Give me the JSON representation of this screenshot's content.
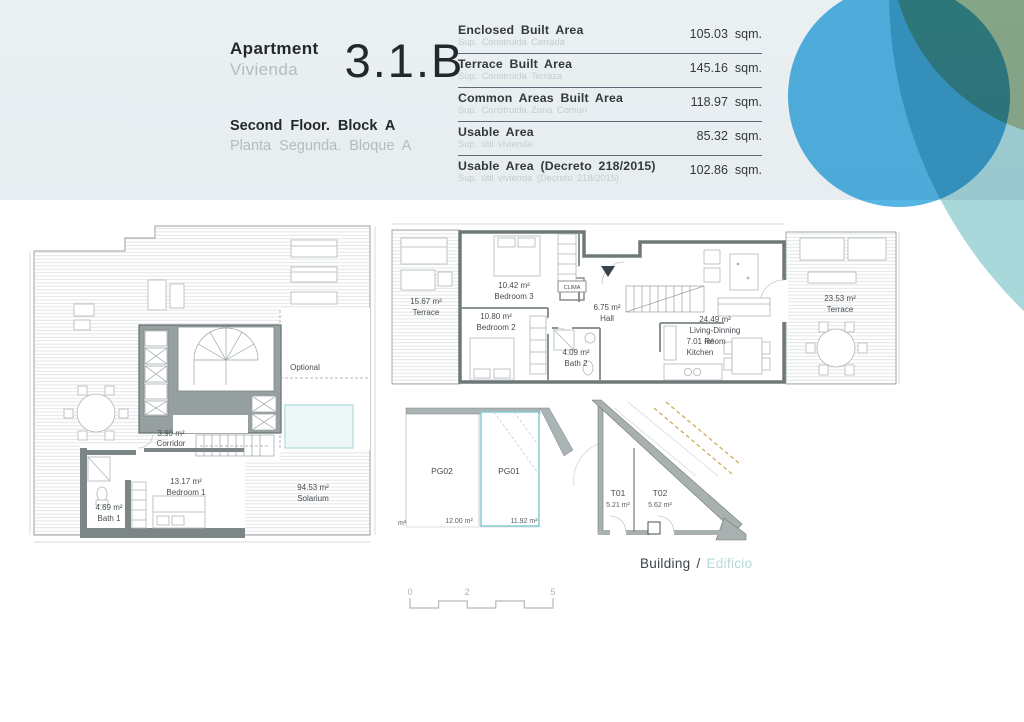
{
  "header": {
    "apartment_en": "Apartment",
    "apartment_es": "Vivienda",
    "unit": "3.1.B",
    "floor_en": "Second Floor. Block A",
    "floor_es": "Planta Segunda. Bloque A"
  },
  "areas_table": {
    "rows": [
      {
        "label_en": "Enclosed Built Area",
        "label_es": "Sup. Construida Cerrada",
        "value": "105.03",
        "unit": "sqm."
      },
      {
        "label_en": "Terrace Built Area",
        "label_es": "Sup. Construida Terraza",
        "value": "145.16",
        "unit": "sqm."
      },
      {
        "label_en": "Common Areas Built Area",
        "label_es": "Sup. Construida Zona Común",
        "value": "118.97",
        "unit": "sqm."
      },
      {
        "label_en": "Usable Area",
        "label_es": "Sup. útil vivienda",
        "value": "85.32",
        "unit": "sqm."
      },
      {
        "label_en": "Usable Area (Decreto 218/2015)",
        "label_es": "Sup. útil vivienda (Decreto 218/2015)",
        "value": "102.86",
        "unit": "sqm."
      }
    ]
  },
  "solarium_plan": {
    "rooms": [
      {
        "area": "3.90 m²",
        "name": "Corridor"
      },
      {
        "area": "13.17 m²",
        "name": "Bedroom 1"
      },
      {
        "area": "4.69 m²",
        "name": "Bath 1"
      },
      {
        "area": "94.53 m²",
        "name": "Solarium"
      }
    ],
    "optional_label": "Optional"
  },
  "main_plan": {
    "rooms": [
      {
        "area": "15.67 m²",
        "name": "Terrace"
      },
      {
        "area": "10.42 m²",
        "name": "Bedroom 3"
      },
      {
        "area": "10.80 m²",
        "name": "Bedroom 2"
      },
      {
        "area": "4.09 m²",
        "name": "Bath 2"
      },
      {
        "area": "6.75 m²",
        "name": "Hall"
      },
      {
        "area": "7.01 m²",
        "name": "Kitchen"
      },
      {
        "area": "24.49 m²",
        "name": "Living-Dinning",
        "name2": "Room"
      },
      {
        "area": "23.53 m²",
        "name": "Terrace"
      }
    ],
    "clima_label": "CLIMA"
  },
  "parking_plan": {
    "spaces": [
      {
        "code": "PG02",
        "area": "12.00 m²"
      },
      {
        "code": "PG01",
        "area": "11.92 m²"
      }
    ],
    "unit_note": "m²"
  },
  "storage_plan": {
    "units": [
      {
        "code": "T01",
        "area": "5.21 m²"
      },
      {
        "code": "T02",
        "area": "5.62 m²"
      }
    ]
  },
  "footer": {
    "building_en": "Building",
    "separator": "/",
    "building_es": "Edificio"
  },
  "scale_bar": {
    "ticks": [
      "0",
      "2",
      "5"
    ]
  },
  "colors": {
    "header_band": "#e9eef1",
    "circle_blue": "#55b6e6",
    "circle_tan": "#dbcfa6",
    "circle_pale_teal": "#a9d8db",
    "accent_teal": "#86ccd1",
    "wall_gray": "#8b9494",
    "dashed_tan": "#c9a94f"
  }
}
